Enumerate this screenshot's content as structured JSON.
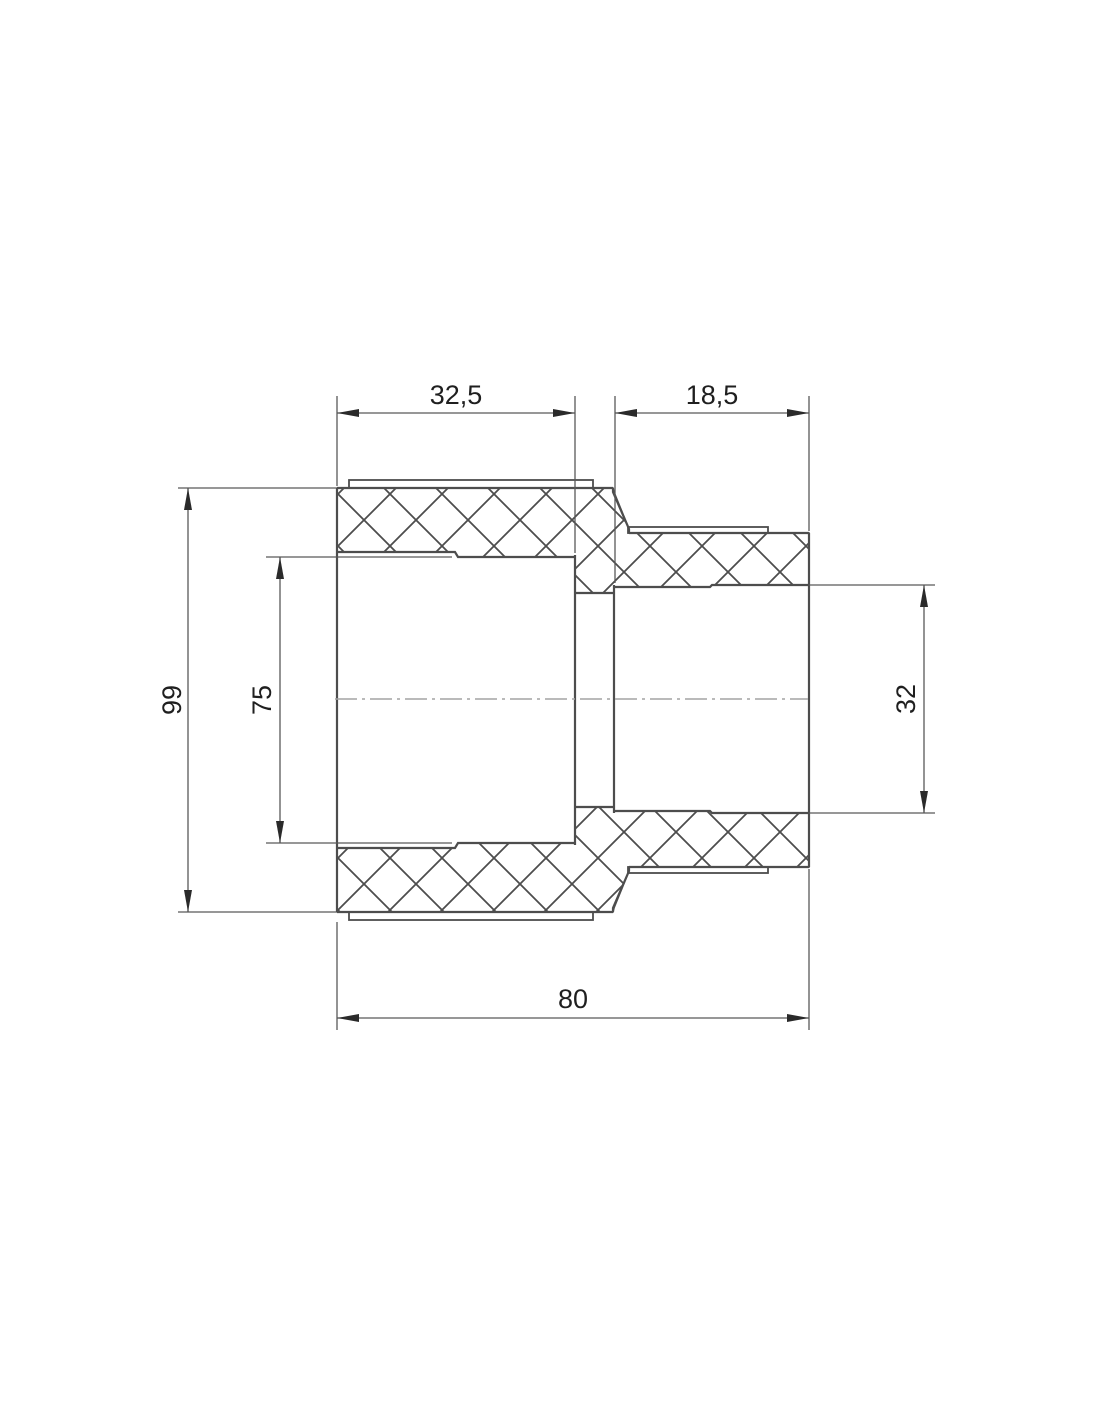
{
  "drawing": {
    "kind": "pipe-fitting-cross-section",
    "dimensions": {
      "left_socket_depth": "32,5",
      "right_socket_depth": "18,5",
      "outer_diameter": "99",
      "left_bore_diameter": "75",
      "right_bore_diameter": "32",
      "overall_length": "80"
    },
    "colors": {
      "object_line": "#4d4d4d",
      "dimension_line": "#595959",
      "text": "#1f1f1f",
      "centerline": "#a3a3a3",
      "background": "#ffffff"
    }
  }
}
